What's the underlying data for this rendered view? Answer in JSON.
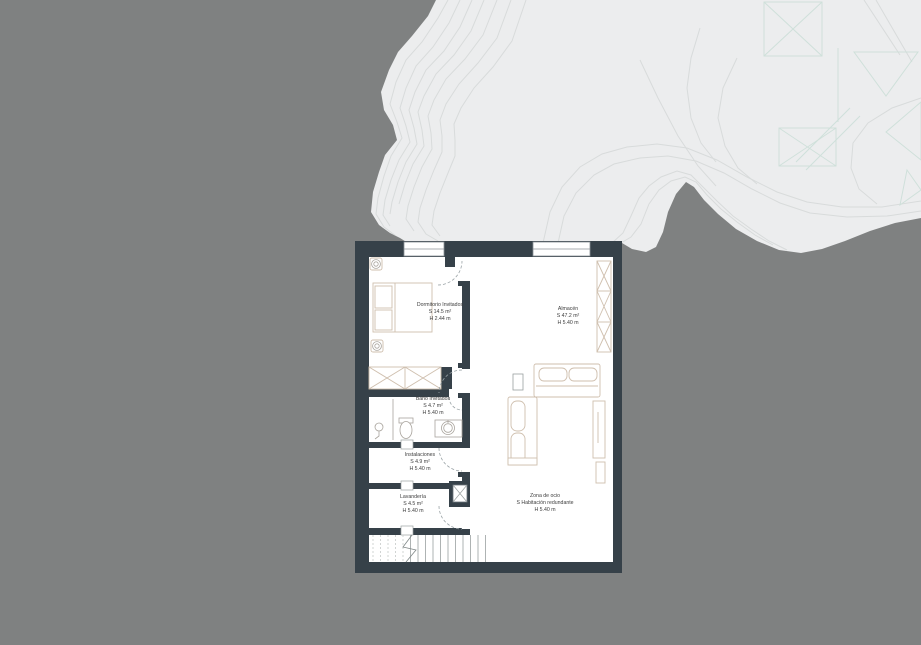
{
  "colors": {
    "background": "#7f8181",
    "terrain": "#ecedee",
    "contour_line": "#d8dbdb",
    "vegetation_line": "#cfe0da",
    "wall": "#364149",
    "room_fill": "#ffffff",
    "furniture_line": "#cfbfae",
    "fixture_line": "#a9a49d",
    "door_swing": "#9aa3a6",
    "stair_line": "#9aa0a0",
    "text": "#3c3c3c"
  },
  "rooms": [
    {
      "id": "dormitorio",
      "name": "Dormitorio Invitados",
      "area": "S 14.5 m²",
      "height": "H 2.44 m"
    },
    {
      "id": "almacen",
      "name": "Almacén",
      "area": "S 47.2 m²",
      "height": "H 5.40 m"
    },
    {
      "id": "bano",
      "name": "Baño Invitados",
      "area": "S 4.7 m²",
      "height": "H 5.40 m"
    },
    {
      "id": "instalaciones",
      "name": "Instalaciones",
      "area": "S 4.9 m²",
      "height": "H 5.40 m"
    },
    {
      "id": "lavanderia",
      "name": "Lavandería",
      "area": "S 4.5 m²",
      "height": "H 5.40 m"
    },
    {
      "id": "zona_ocio",
      "name": "Zona de ocio",
      "area": "S Habitación redundante",
      "height": "H 5.40 m"
    }
  ]
}
